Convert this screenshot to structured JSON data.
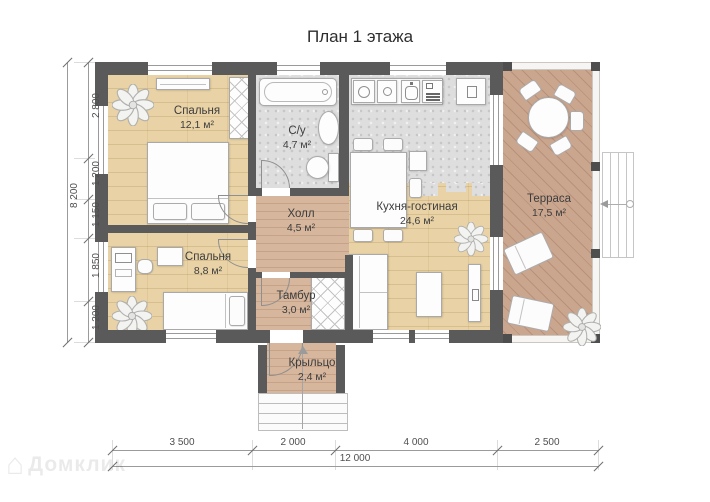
{
  "title": "План 1 этажа",
  "rooms": [
    {
      "name": "Спальня",
      "area": "12,1 м²"
    },
    {
      "name": "С/у",
      "area": "4,7 м²"
    },
    {
      "name": "Кухня-гостиная",
      "area": "24,6 м²"
    },
    {
      "name": "Холл",
      "area": "4,5 м²"
    },
    {
      "name": "Спальня",
      "area": "8,8 м²"
    },
    {
      "name": "Тамбур",
      "area": "3,0 м²"
    },
    {
      "name": "Крыльцо",
      "area": "2,4 м²"
    },
    {
      "name": "Терраса",
      "area": "17,5 м²"
    }
  ],
  "dimensions": {
    "left_total": "8 200",
    "left_segments": [
      "2 800",
      "1 200",
      "1 150",
      "1 850",
      "1 200"
    ],
    "bottom_segments": [
      "3 500",
      "2 000",
      "4 000",
      "2 500"
    ],
    "bottom_total": "12 000"
  },
  "watermark": {
    "icon": "⌂",
    "text": "Домклик"
  },
  "colors": {
    "wall": "#5a5a5a",
    "wood_floor": "#e9d3a6",
    "hall_floor": "#d6b69d",
    "terrace_floor": "#cba68f",
    "tile_floor": "#dedede"
  }
}
